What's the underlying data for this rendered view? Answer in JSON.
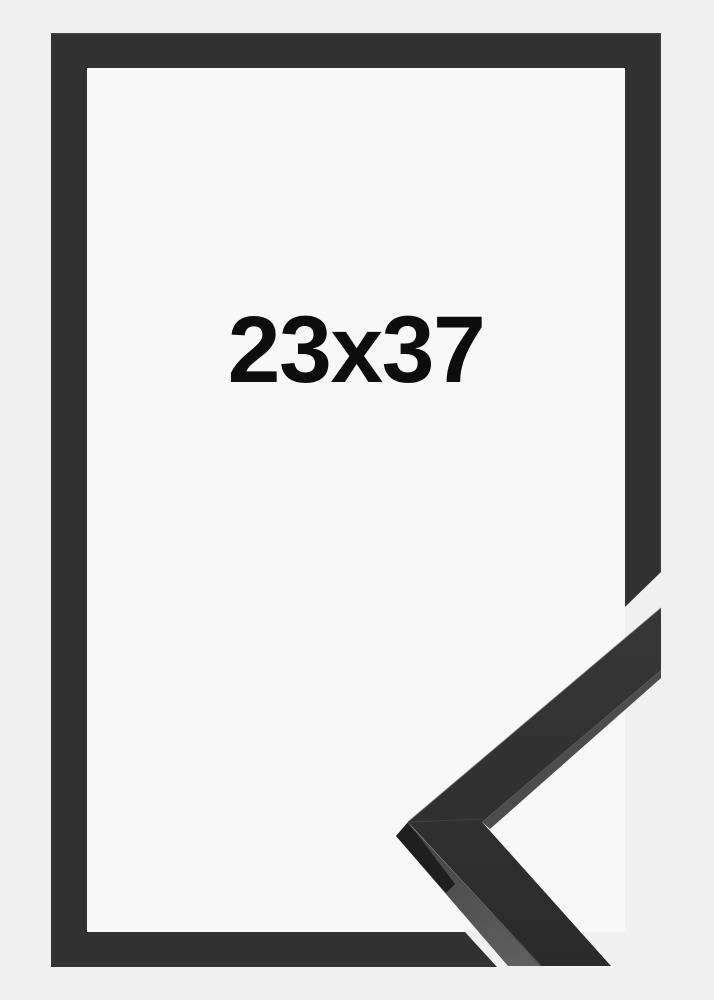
{
  "product": {
    "size_label": "23x37"
  },
  "colors": {
    "background": "#f0f0f0",
    "opening": "#f8f8f8",
    "frame": "#323232",
    "frame_edge_highlight": "#4a4a4a",
    "profile_top_light": "#373737",
    "profile_top_dark": "#2b2b2b",
    "profile_side_top": "#434343",
    "profile_side_bottom": "#5e5e5e",
    "profile_end_face": "#1f1f1f",
    "profile_lip": "#4d4d4d",
    "miter_seam": "#454545",
    "label_text": "#0d0d0d"
  }
}
